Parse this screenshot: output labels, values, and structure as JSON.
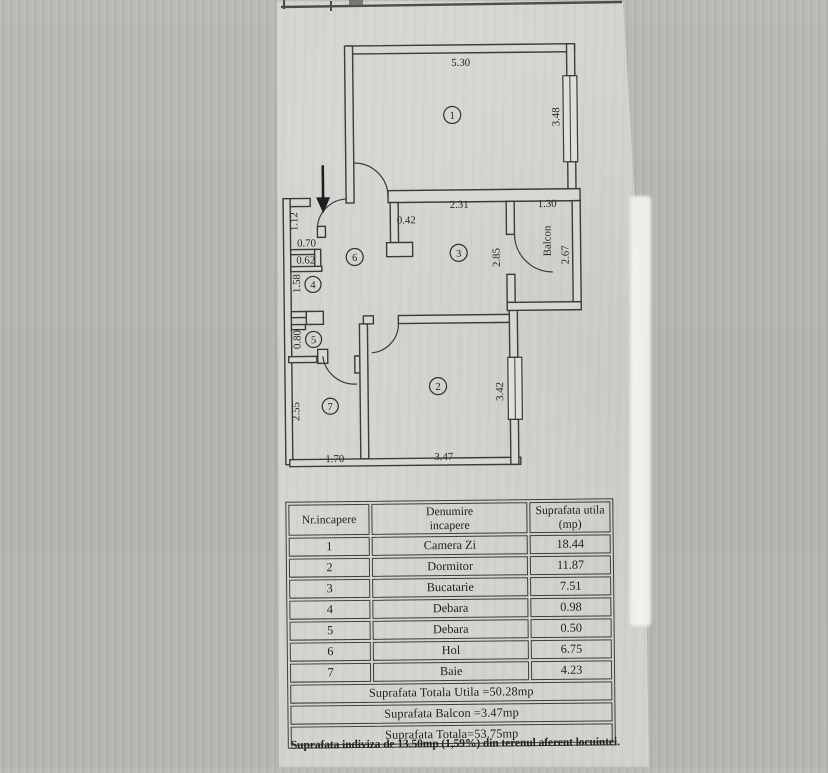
{
  "plan": {
    "icons": {
      "entrance_arrow": "down-arrow"
    },
    "labels": {
      "room1_width": "5.30",
      "room1_height": "3.48",
      "entry_wall": "1.12",
      "entry_opening": "0.70",
      "niche_width": "0.62",
      "debara4_height": "1.58",
      "debara5_height": "0.80",
      "baie_height": "2.55",
      "baie_width": "1.70",
      "room2_width": "3.47",
      "room2_height": "3.42",
      "kitchen_niche": "0.42",
      "kitchen_width": "2.31",
      "kitchen_height": "2.85",
      "balcony_width": "1.30",
      "balcony_height": "2.67",
      "balcony_name": "Balcon"
    },
    "room_numbers": {
      "living": "1",
      "bedroom": "2",
      "kitchen": "3",
      "debara4": "4",
      "debara5": "5",
      "hall": "6",
      "bath": "7"
    }
  },
  "table": {
    "headers": {
      "nr": "Nr.incapere",
      "name_line1": "Denumire",
      "name_line2": "incapere",
      "area_line1": "Suprafata utila",
      "area_line2": "(mp)"
    },
    "rows": [
      {
        "nr": "1",
        "name": "Camera Zi",
        "area": "18.44"
      },
      {
        "nr": "2",
        "name": "Dormitor",
        "area": "11.87"
      },
      {
        "nr": "3",
        "name": "Bucatarie",
        "area": "7.51"
      },
      {
        "nr": "4",
        "name": "Debara",
        "area": "0.98"
      },
      {
        "nr": "5",
        "name": "Debara",
        "area": "0.50"
      },
      {
        "nr": "6",
        "name": "Hol",
        "area": "6.75"
      },
      {
        "nr": "7",
        "name": "Baie",
        "area": "4.23"
      }
    ],
    "totals": [
      "Suprafata Totala Utila =50.28mp",
      "Suprafata Balcon =3.47mp",
      "Suprafata Totala=53.75mp"
    ]
  },
  "footer": {
    "note": "Suprafata indiviza de 13.50mp (1,59%) din terenul aferent locuintei."
  }
}
